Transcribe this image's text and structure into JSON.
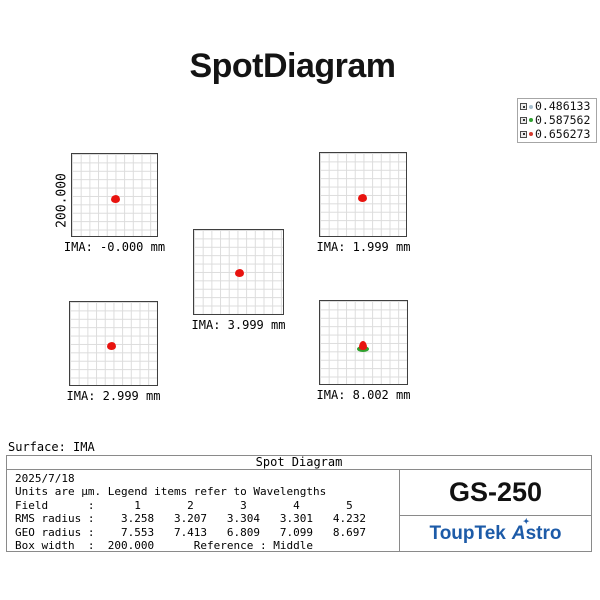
{
  "title": "SpotDiagram",
  "legend": {
    "entries": [
      {
        "wavelength": "0.486133",
        "color": "#a7bfcf"
      },
      {
        "wavelength": "0.587562",
        "color": "#2fa12f"
      },
      {
        "wavelength": "0.656273",
        "color": "#d33b2f"
      }
    ]
  },
  "scale_label": "200.000",
  "panels": [
    {
      "label": "IMA: -0.000 mm"
    },
    {
      "label": "IMA: 1.999 mm"
    },
    {
      "label": "IMA: 3.999 mm"
    },
    {
      "label": "IMA: 2.999 mm"
    },
    {
      "label": "IMA: 8.002 mm"
    }
  ],
  "surface_label": "Surface: IMA",
  "table": {
    "header": "Spot Diagram",
    "rows": [
      "2025/7/18",
      "Units are µm. Legend items refer to Wavelengths",
      "Field      :      1       2       3       4       5",
      "RMS radius :    3.258   3.207   3.304   3.301   4.232",
      "GEO radius :    7.553   7.413   6.809   7.099   8.697",
      "Box width  :  200.000      Reference : Middle"
    ],
    "model": "GS-250",
    "brand": {
      "word1": "ToupTek",
      "a": "A",
      "star": "✦",
      "word2": "stro"
    }
  },
  "chart_data": {
    "type": "scatter",
    "title": "SpotDiagram",
    "surface": "IMA",
    "date": "2025/7/18",
    "units": "µm",
    "legend_position": "top-right",
    "wavelengths_um": [
      0.486133,
      0.587562,
      0.656273
    ],
    "wavelength_colors": [
      "#a7bfcf",
      "#2fa12f",
      "#d33b2f"
    ],
    "fields": [
      1,
      2,
      3,
      4,
      5
    ],
    "panel_ima_mm_display_order": [
      "-0.000",
      "1.999",
      "3.999",
      "2.999",
      "8.002"
    ],
    "rms_radius_um": [
      3.258,
      3.207,
      3.304,
      3.301,
      4.232
    ],
    "geo_radius_um": [
      7.553,
      7.413,
      6.809,
      7.099,
      8.697
    ],
    "box_width_um": 200.0,
    "reference": "Middle",
    "grid": true,
    "spots": [
      {
        "ima_mm": "-0.000",
        "x_frac": 0.5,
        "y_frac": 0.53,
        "visible_colors": [
          "red"
        ]
      },
      {
        "ima_mm": "1.999",
        "x_frac": 0.49,
        "y_frac": 0.53,
        "visible_colors": [
          "red"
        ]
      },
      {
        "ima_mm": "3.999",
        "x_frac": 0.5,
        "y_frac": 0.5,
        "visible_colors": [
          "red"
        ]
      },
      {
        "ima_mm": "2.999",
        "x_frac": 0.47,
        "y_frac": 0.52,
        "visible_colors": [
          "red"
        ]
      },
      {
        "ima_mm": "8.002",
        "x_frac": 0.48,
        "y_frac": 0.53,
        "visible_colors": [
          "green",
          "red"
        ]
      }
    ]
  }
}
